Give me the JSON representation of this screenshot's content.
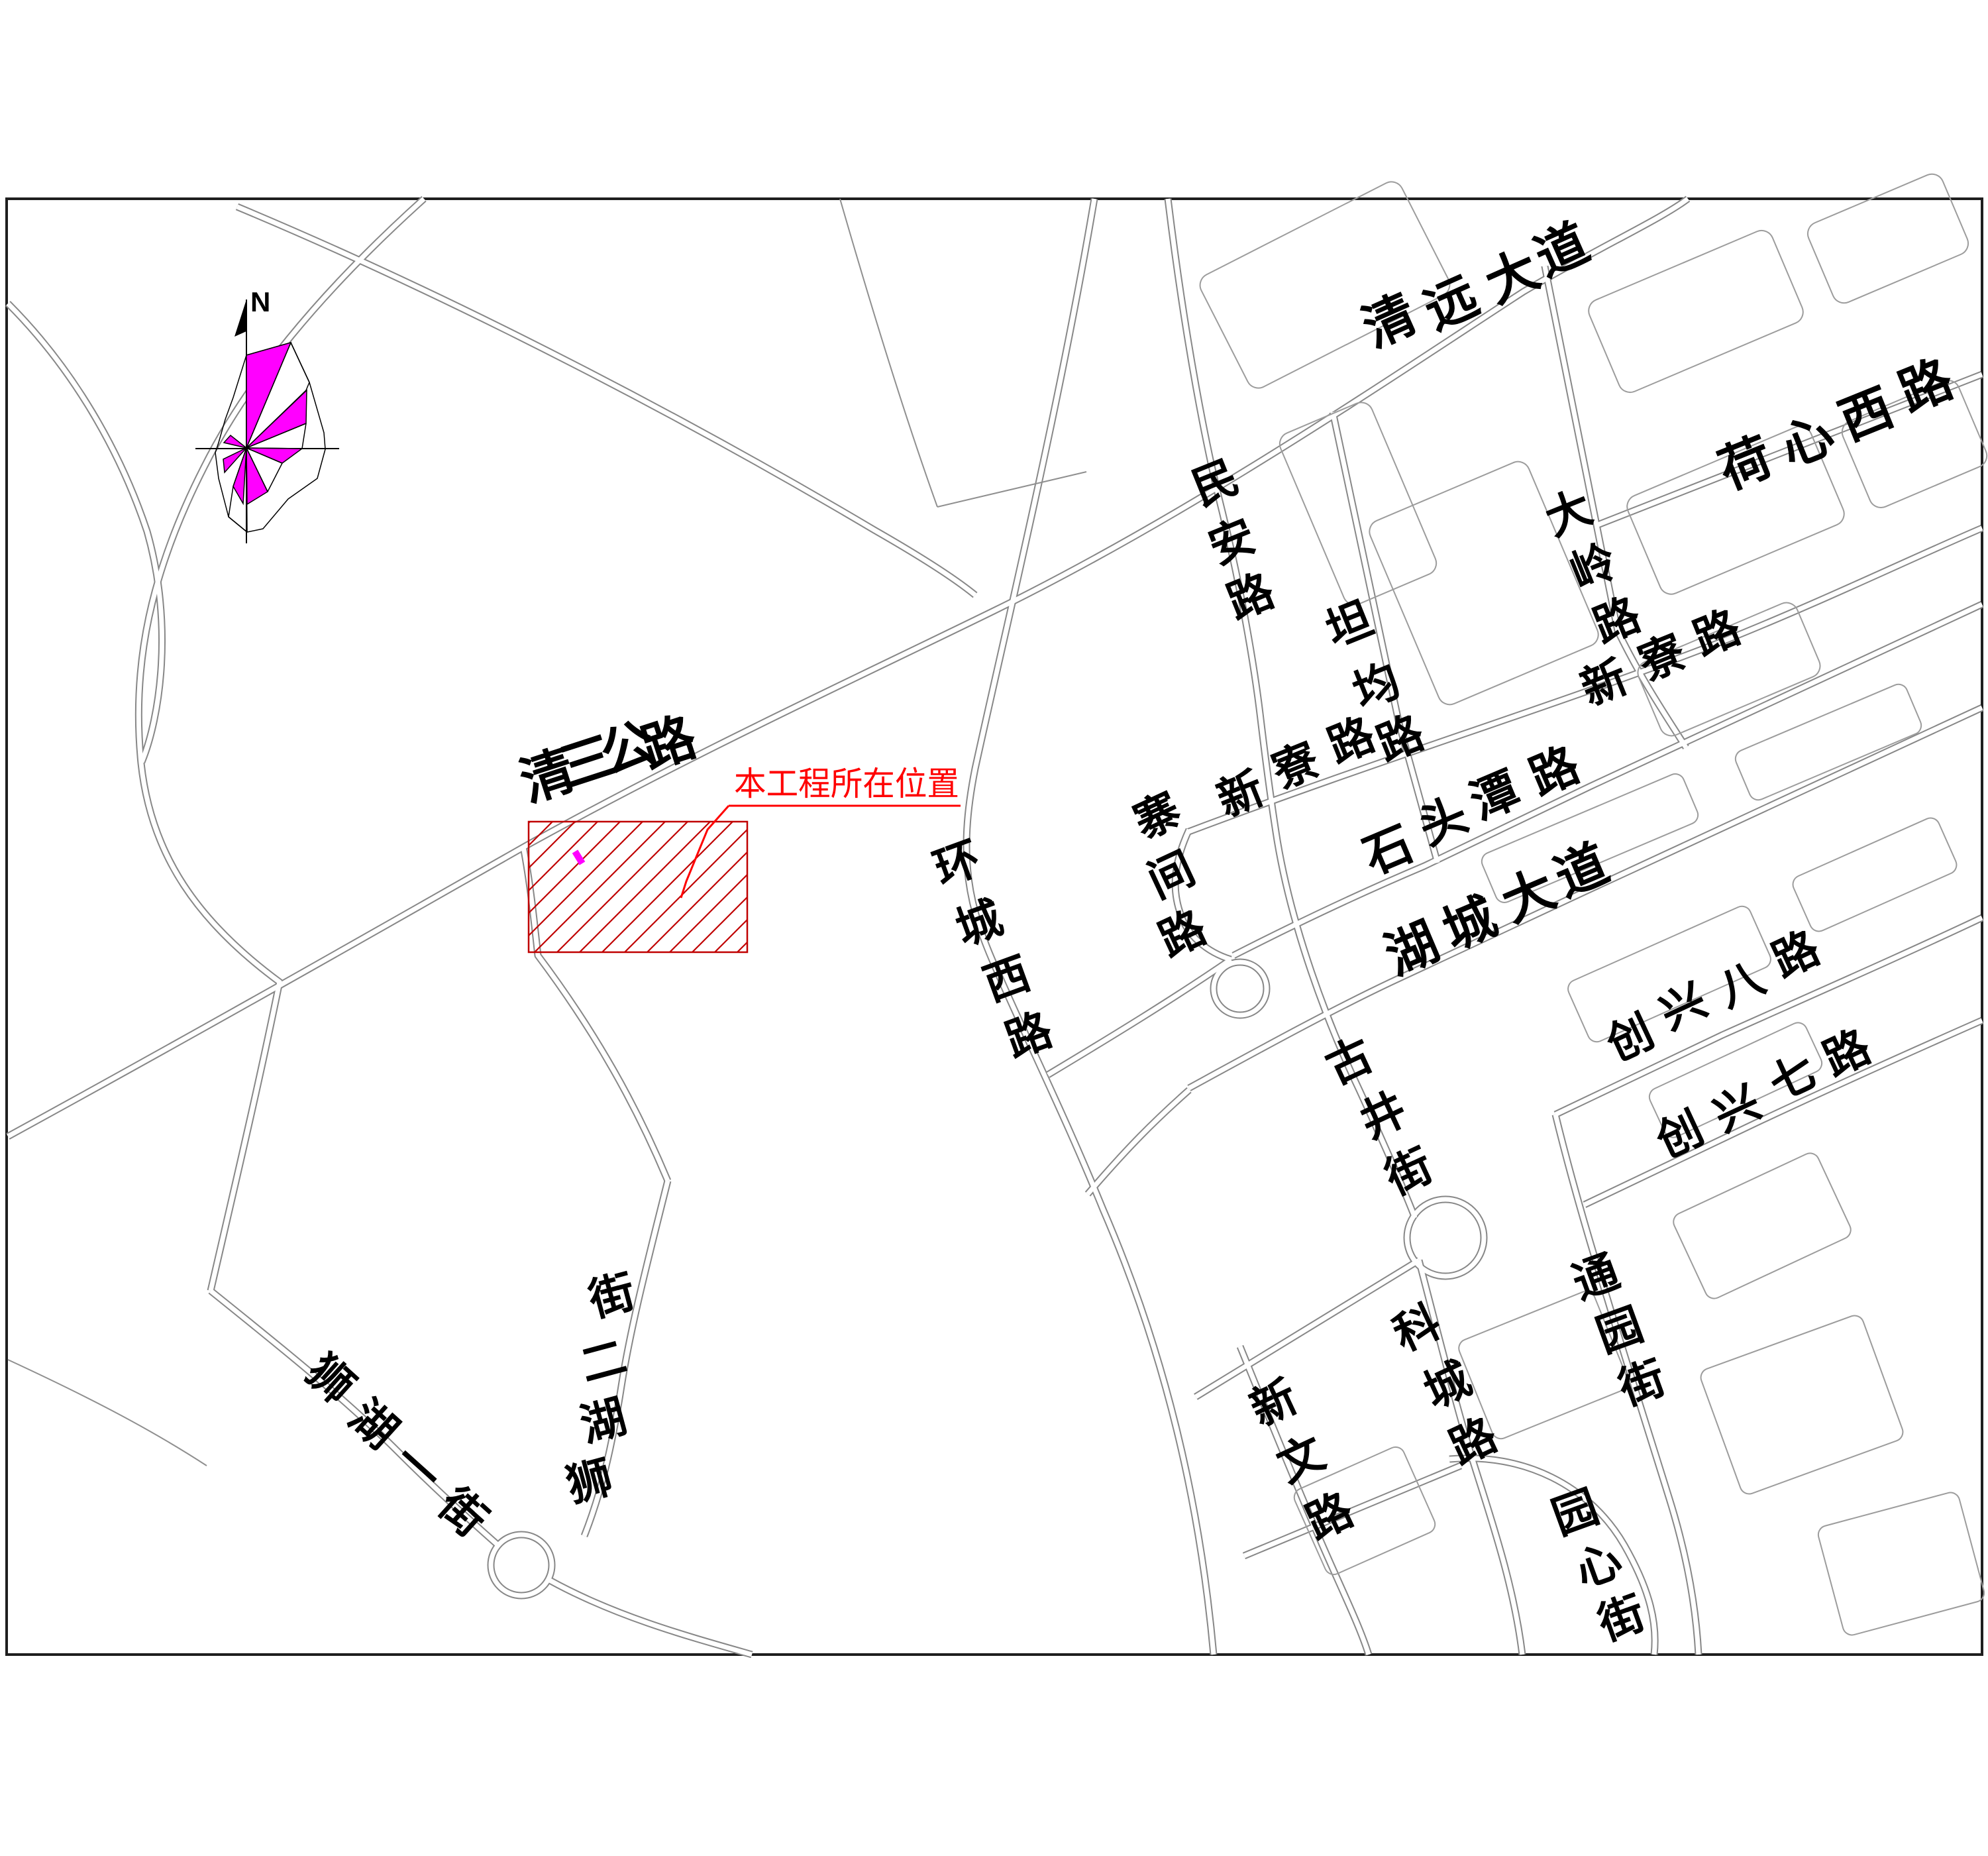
{
  "page": {
    "background": "#ffffff"
  },
  "compass": {
    "north_label": "N",
    "rose_fill_color": "#ff00ff"
  },
  "project": {
    "label": "本工程所在位置",
    "label_color": "#ff0000",
    "hatch_color": "#c00000",
    "site_marker_color": "#ff00ff"
  },
  "map": {
    "road_line_color": "#878787",
    "frame_color": "#1f1f1f"
  },
  "road_labels": [
    "清远大道",
    "荷心西路",
    "民安路",
    "坦均路",
    "大岭路",
    "新寮路",
    "新寮路",
    "寨间路",
    "石头潭路",
    "湖城大道",
    "环城西路",
    "古井街",
    "创兴八路",
    "创兴七路",
    "通园街",
    "科城路",
    "新文路",
    "园心街",
    "清三公路",
    "狮湖一街",
    "狮湖二街"
  ]
}
